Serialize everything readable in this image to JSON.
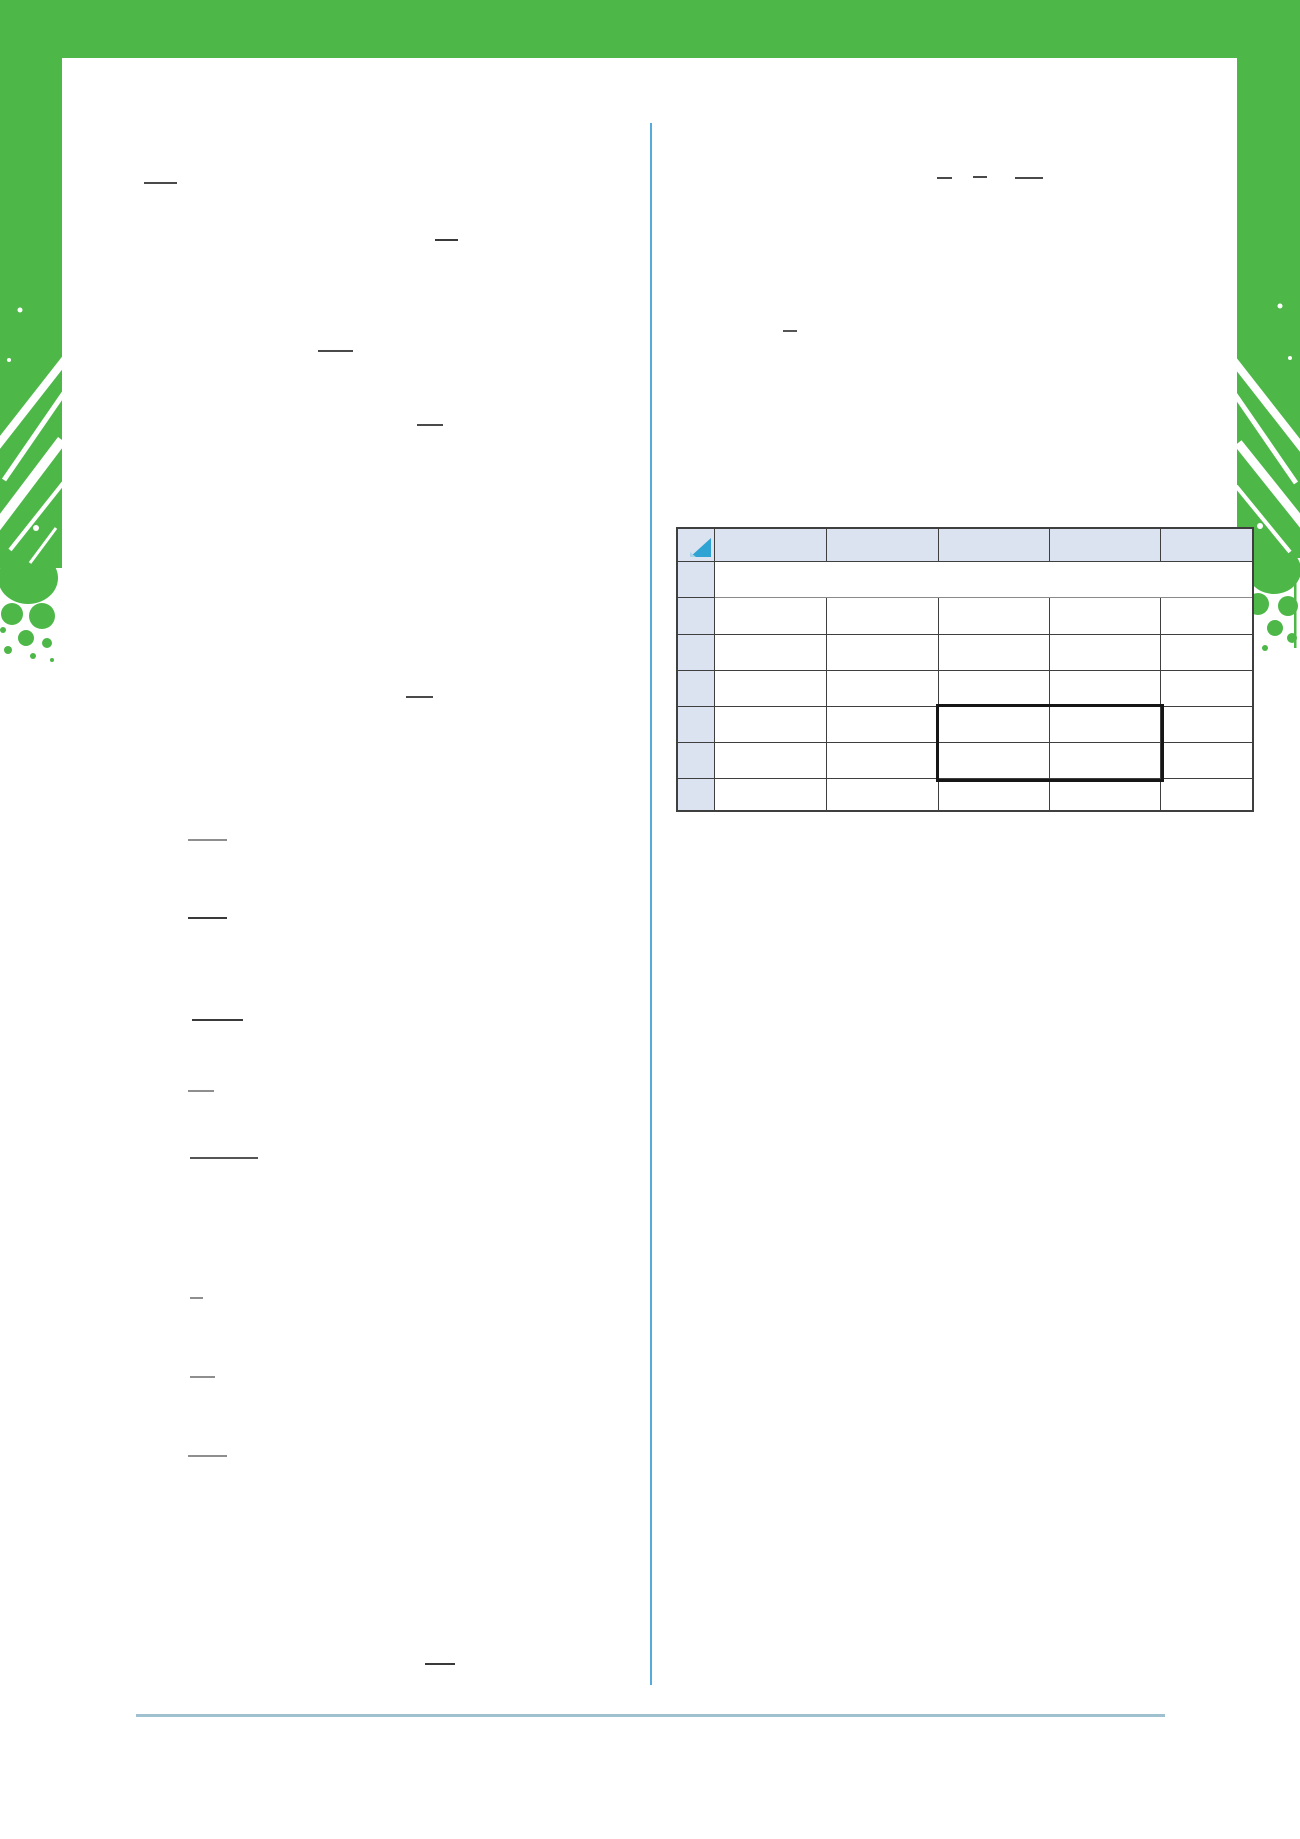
{
  "page": {
    "width": 1300,
    "height": 1839,
    "background": "#ffffff"
  },
  "frame": {
    "color": "#4db848",
    "top_bar": {
      "x": 0,
      "y": 0,
      "width": 1300,
      "height": 58
    },
    "left_band": {
      "x": 0,
      "y_top": 58,
      "width": 62,
      "solid_until_y": 438,
      "splatter_end_y": 668
    },
    "right_band": {
      "x": 1237,
      "y_top": 58,
      "width": 63,
      "solid_until_y": 438,
      "splatter_end_y": 648
    }
  },
  "column_divider": {
    "x": 650,
    "y1": 123,
    "y2": 1685,
    "color": "#57abdb"
  },
  "footer_rule": {
    "x1": 136,
    "x2": 1165,
    "y": 1714,
    "color": "#9fc1cf"
  },
  "fraction_bars": [
    {
      "x": 144,
      "y": 182,
      "w": 33,
      "color": "#4a4a4a"
    },
    {
      "x": 435,
      "y": 239,
      "w": 23,
      "color": "#3a3a3a"
    },
    {
      "x": 318,
      "y": 350,
      "w": 35,
      "color": "#4a4a4a"
    },
    {
      "x": 417,
      "y": 424,
      "w": 26,
      "color": "#4a4a4a"
    },
    {
      "x": 406,
      "y": 696,
      "w": 27,
      "color": "#4a4a4a"
    },
    {
      "x": 188,
      "y": 839,
      "w": 39,
      "color": "#8e8e8e"
    },
    {
      "x": 188,
      "y": 917,
      "w": 39,
      "color": "#3a3a3a"
    },
    {
      "x": 192,
      "y": 1019,
      "w": 51,
      "color": "#3a3a3a"
    },
    {
      "x": 188,
      "y": 1090,
      "w": 26,
      "color": "#8e8e8e"
    },
    {
      "x": 190,
      "y": 1157,
      "w": 68,
      "color": "#555555"
    },
    {
      "x": 190,
      "y": 1297,
      "w": 13,
      "color": "#8e8e8e"
    },
    {
      "x": 190,
      "y": 1376,
      "w": 25,
      "color": "#8e8e8e"
    },
    {
      "x": 188,
      "y": 1455,
      "w": 39,
      "color": "#8e8e8e"
    },
    {
      "x": 425,
      "y": 1663,
      "w": 30,
      "color": "#3a3a3a"
    },
    {
      "x": 937,
      "y": 177,
      "w": 15,
      "color": "#4a4a4a"
    },
    {
      "x": 973,
      "y": 176,
      "w": 14,
      "color": "#4a4a4a"
    },
    {
      "x": 1015,
      "y": 177,
      "w": 28,
      "color": "#4a4a4a"
    },
    {
      "x": 783,
      "y": 330,
      "w": 14,
      "color": "#555555"
    }
  ],
  "table": {
    "x": 676,
    "y": 527,
    "col_widths": [
      37,
      112,
      112,
      111,
      111,
      93
    ],
    "row_heights": [
      33,
      36,
      37,
      36,
      36,
      36,
      36,
      33
    ],
    "header_fill": "#dae3ef",
    "row_header_fill": "#dae3ef",
    "body_fill": "#ffffff",
    "grid_color": "#3f3f3f",
    "merged_body_row_index": 0,
    "corner_icon": {
      "name": "sort-triangle",
      "color": "#2ea3d4",
      "accent": "#aad4ea"
    },
    "highlight_box": {
      "x": 937,
      "y": 705,
      "width": 222,
      "height": 72,
      "border_color": "#161616",
      "border_width": 3
    }
  }
}
